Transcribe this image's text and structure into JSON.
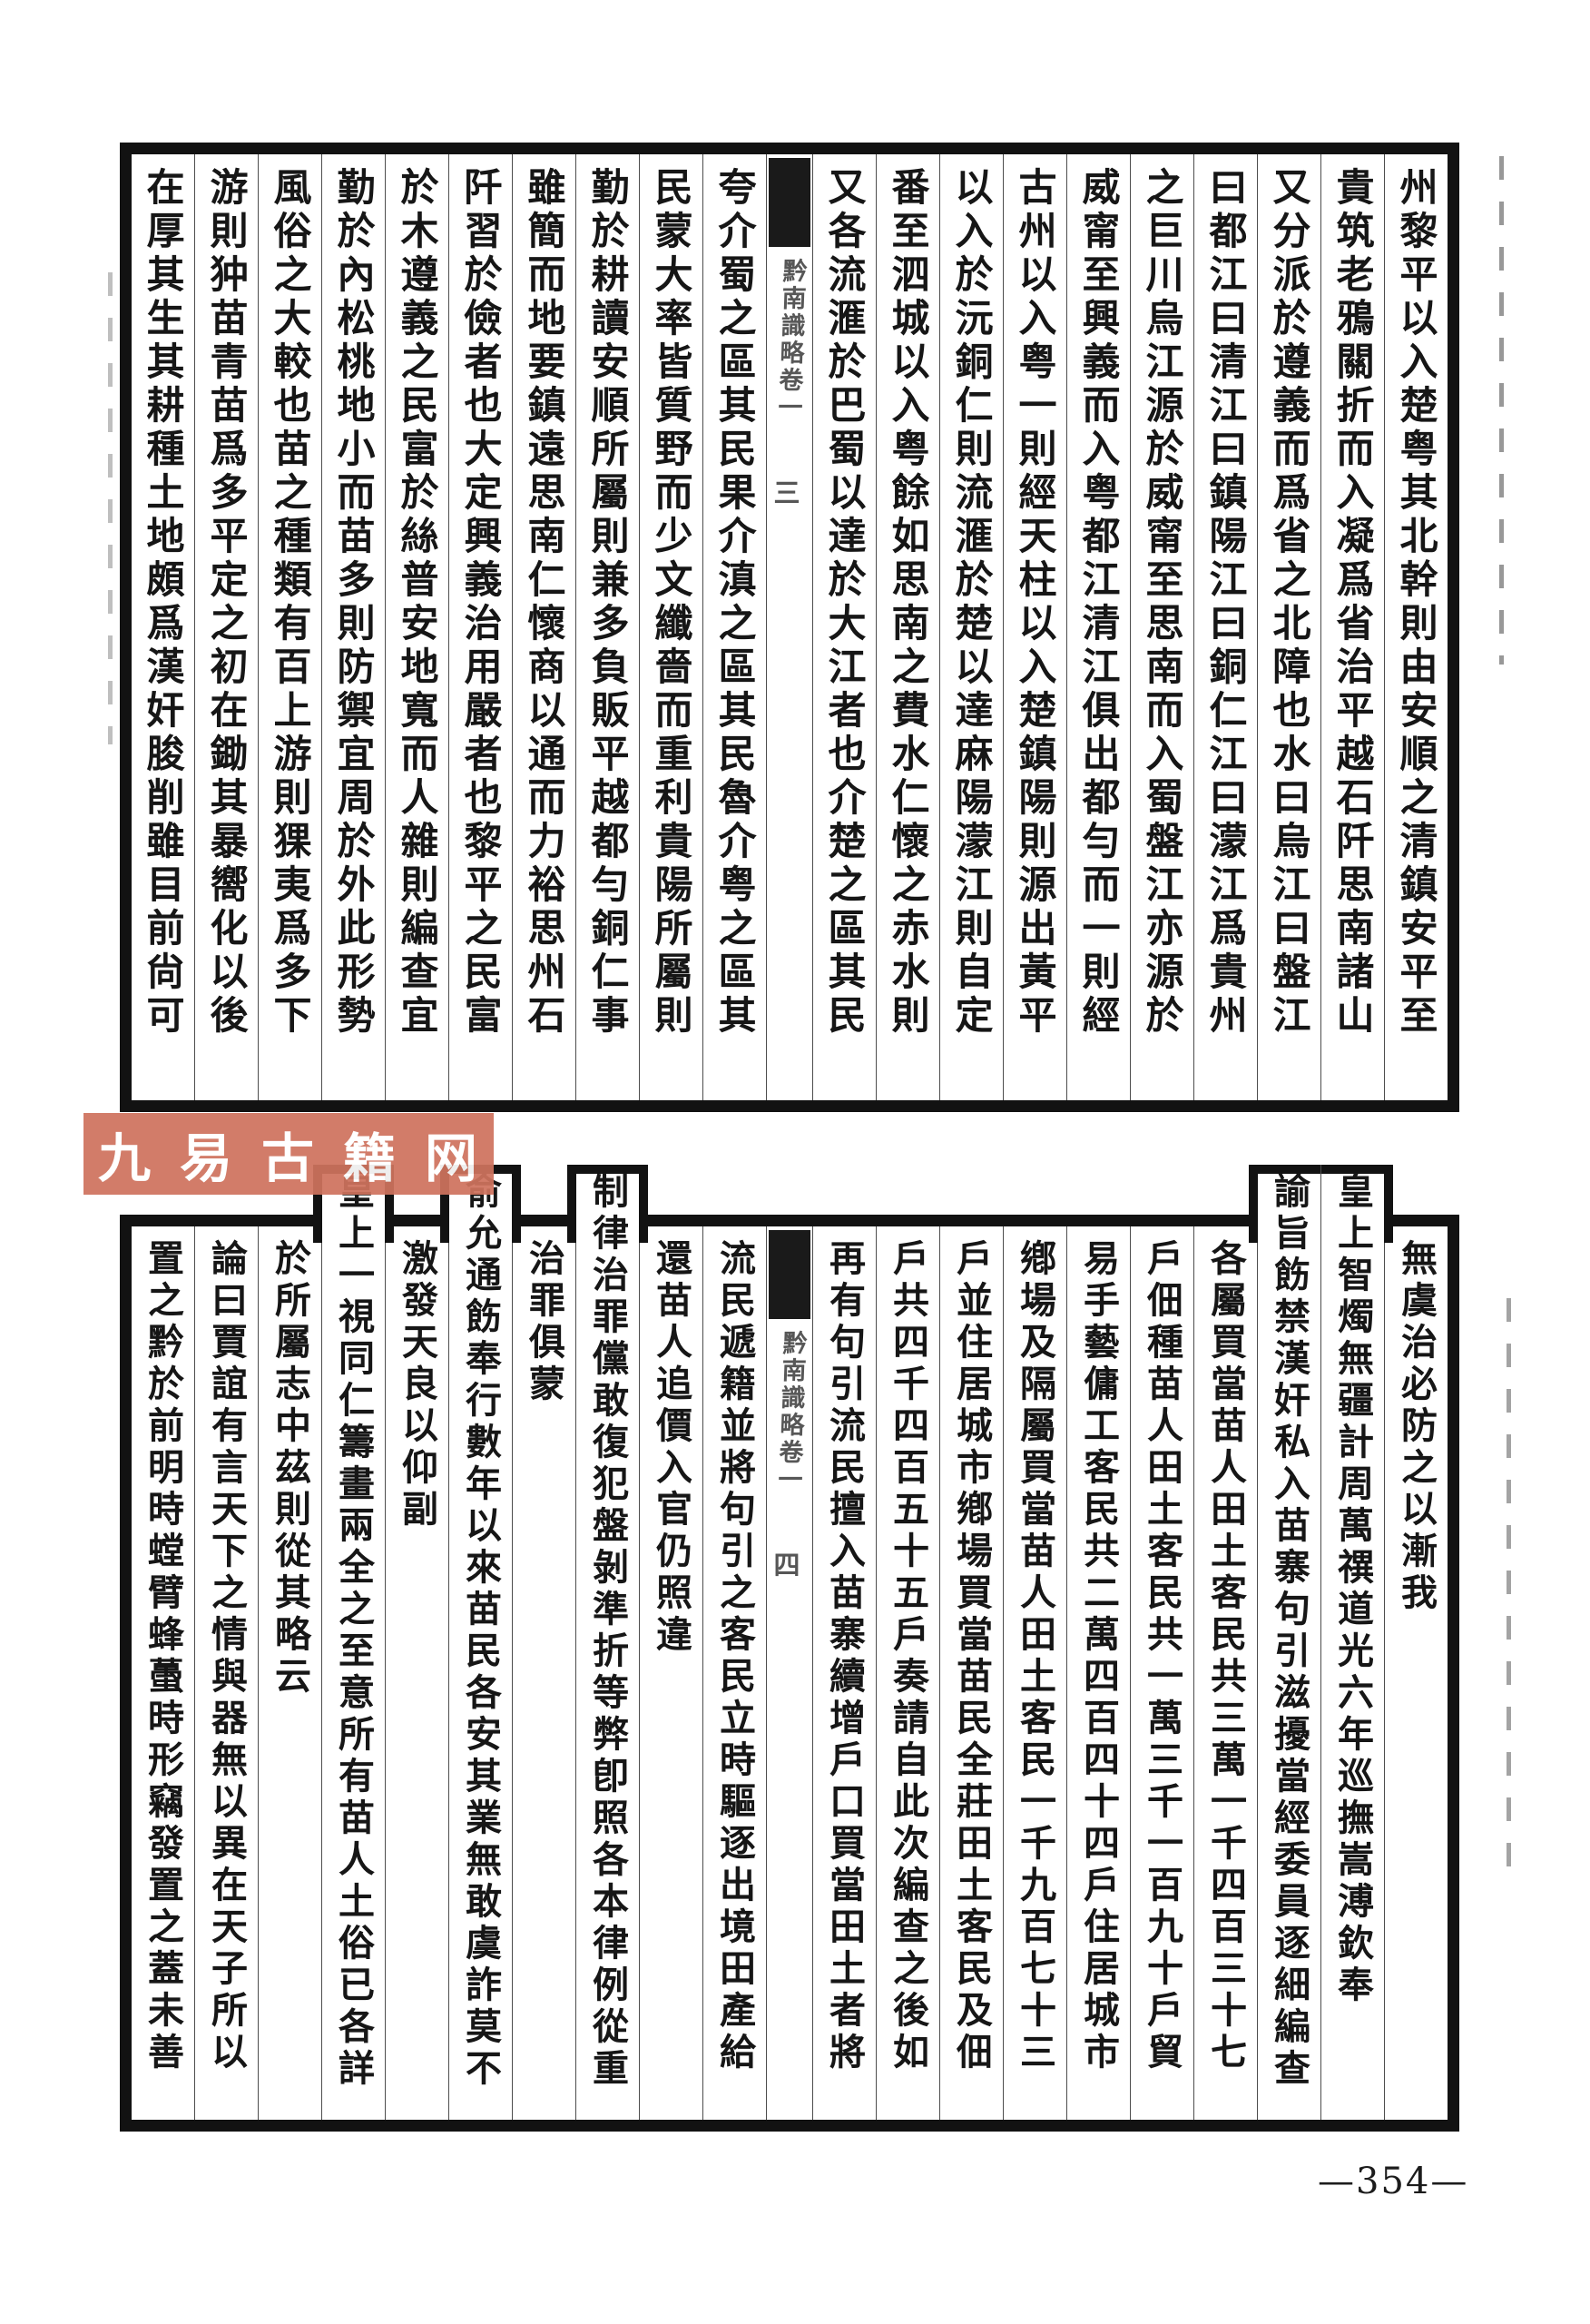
{
  "page": {
    "background": "#ffffff",
    "ink": "#161616",
    "frame_color": "#121212",
    "footer_page_number": "—354—",
    "watermark": {
      "text": "九易古籍网",
      "text_color": "#ffffff",
      "bg": "#cf735e"
    }
  },
  "center_title": "黔南識略卷一",
  "blocks": [
    {
      "id": "top-leaf",
      "center_page_label": "三",
      "columns": [
        {
          "text": "州黎平以入楚粤其北幹則由安順之清鎮安平至"
        },
        {
          "text": "貴筑老鴉關折而入凝爲省治平越石阡思南諸山"
        },
        {
          "text": "又分派於遵義而爲省之北障也水曰烏江曰盤江"
        },
        {
          "text": "曰都江曰清江曰鎮陽江曰銅仁江曰濛江爲貴州"
        },
        {
          "text": "之巨川烏江源於威甯至思南而入蜀盤江亦源於"
        },
        {
          "text": "威甯至興義而入粤都江清江俱出都勻而一則經"
        },
        {
          "text": "古州以入粤一則經天柱以入楚鎮陽則源出黃平"
        },
        {
          "text": "以入於沅銅仁則流滙於楚以達麻陽濛江則自定"
        },
        {
          "text": "番至泗城以入粤餘如思南之費水仁懷之赤水則"
        },
        {
          "text": "又各流滙於巴蜀以達於大江者也介楚之區其民"
        },
        {
          "center": true
        },
        {
          "text": "夸介蜀之區其民果介滇之區其民魯介粤之區其"
        },
        {
          "text": "民蒙大率皆質野而少文纖嗇而重利貴陽所屬則"
        },
        {
          "text": "勤於耕讀安順所屬則兼多負販平越都勻銅仁事"
        },
        {
          "text": "雖簡而地要鎮遠思南仁懷商以通而力裕思州石"
        },
        {
          "text": "阡習於儉者也大定興義治用嚴者也黎平之民富"
        },
        {
          "text": "於木遵義之民富於絲普安地寬而人雜則編查宜"
        },
        {
          "text": "勤於內松桃地小而苗多則防禦宜周於外此形勢"
        },
        {
          "text": "風俗之大較也苗之種類有百上游則猓夷爲多下"
        },
        {
          "text": "游則狆苗青苗爲多平定之初在鋤其暴嚮化以後"
        },
        {
          "text": "在厚其生其耕種土地頗爲漢奸朘削雖目前尙可"
        }
      ]
    },
    {
      "id": "bottom-leaf",
      "center_page_label": "四",
      "columns": [
        {
          "text": "無虞治必防之以漸我"
        },
        {
          "text": "皇上智燭無疆計周萬禩道光六年巡撫嵩溥欽奉",
          "raised": true,
          "cap": "r"
        },
        {
          "text": "諭旨飭禁漢奸私入苗寨句引滋擾當經委員逐細編查",
          "raised": true,
          "cap": "l"
        },
        {
          "text": "各屬買當苗人田土客民共三萬一千四百三十七"
        },
        {
          "text": "戶佃種苗人田土客民共一萬三千一百九十戶貿"
        },
        {
          "text": "易手藝傭工客民共二萬四百四十四戶住居城市"
        },
        {
          "text": "鄕場及隔屬買當苗人田土客民一千九百七十三"
        },
        {
          "text": "戶並住居城市鄕場買當苗民全莊田土客民及佃"
        },
        {
          "text": "戶共四千四百五十五戶奏請自此次編查之後如"
        },
        {
          "text": "再有句引流民擅入苗寨續增戶口買當田土者將"
        },
        {
          "center": true
        },
        {
          "text": "流民遞籍並將句引之客民立時驅逐出境田產給"
        },
        {
          "text": "還苗人追價入官仍照違"
        },
        {
          "text": "制律治罪儻敢復犯盤剝準折等弊卽照各本律例從重",
          "raised": true
        },
        {
          "text": "治罪俱蒙"
        },
        {
          "text": "俞允通飭奉行數年以來苗民各安其業無敢虞詐莫不",
          "raised": true
        },
        {
          "text": "激發天良以仰副"
        },
        {
          "text": "皇上一視同仁籌畫兩全之至意所有苗人土俗已各詳",
          "raised": true
        },
        {
          "text": "於所屬志中茲則從其略云"
        },
        {
          "text": "論曰賈誼有言天下之情與器無以異在天子所以"
        },
        {
          "text": "置之黔於前明時螳臂蜂蠆時形竊發置之蓋未善"
        }
      ]
    }
  ]
}
